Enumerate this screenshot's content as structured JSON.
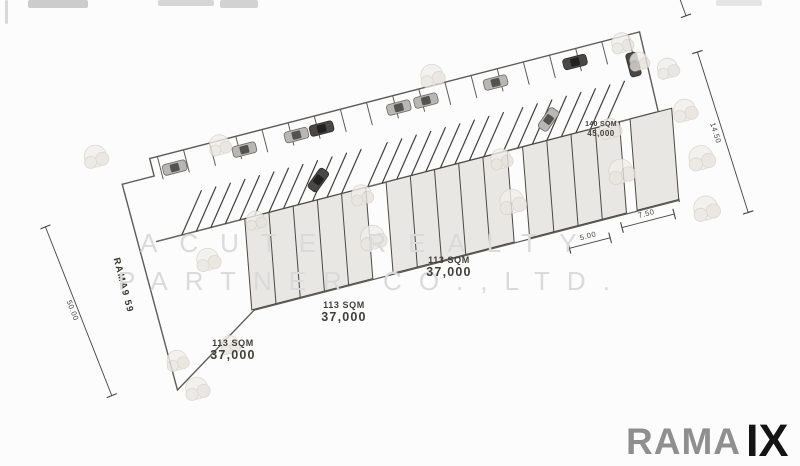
{
  "plan": {
    "street_label": "RAMA9 59",
    "units": [
      {
        "area": "113 SQM",
        "price": "37,000"
      },
      {
        "area": "113 SQM",
        "price": "37,000"
      },
      {
        "area": "113 SQM",
        "price": "37,000"
      },
      {
        "area": "140 SQM",
        "price": "45,000"
      }
    ],
    "dimensions": {
      "left": "50.00",
      "top_right": "6.00",
      "right": "14.50",
      "bottom_small": "5.00",
      "bottom_large": "7.50"
    }
  },
  "watermark": {
    "line1": "ACUTE REALTY",
    "line2": "PARTNER CO.,LTD."
  },
  "logo": {
    "name": "RAMA",
    "suffix": "IX"
  },
  "colors": {
    "line": "#5e5b56",
    "building_fill": "#e9e7e4",
    "logo_gray": "#8f8f8f",
    "logo_black": "#141414",
    "watermark": "#dadada"
  }
}
